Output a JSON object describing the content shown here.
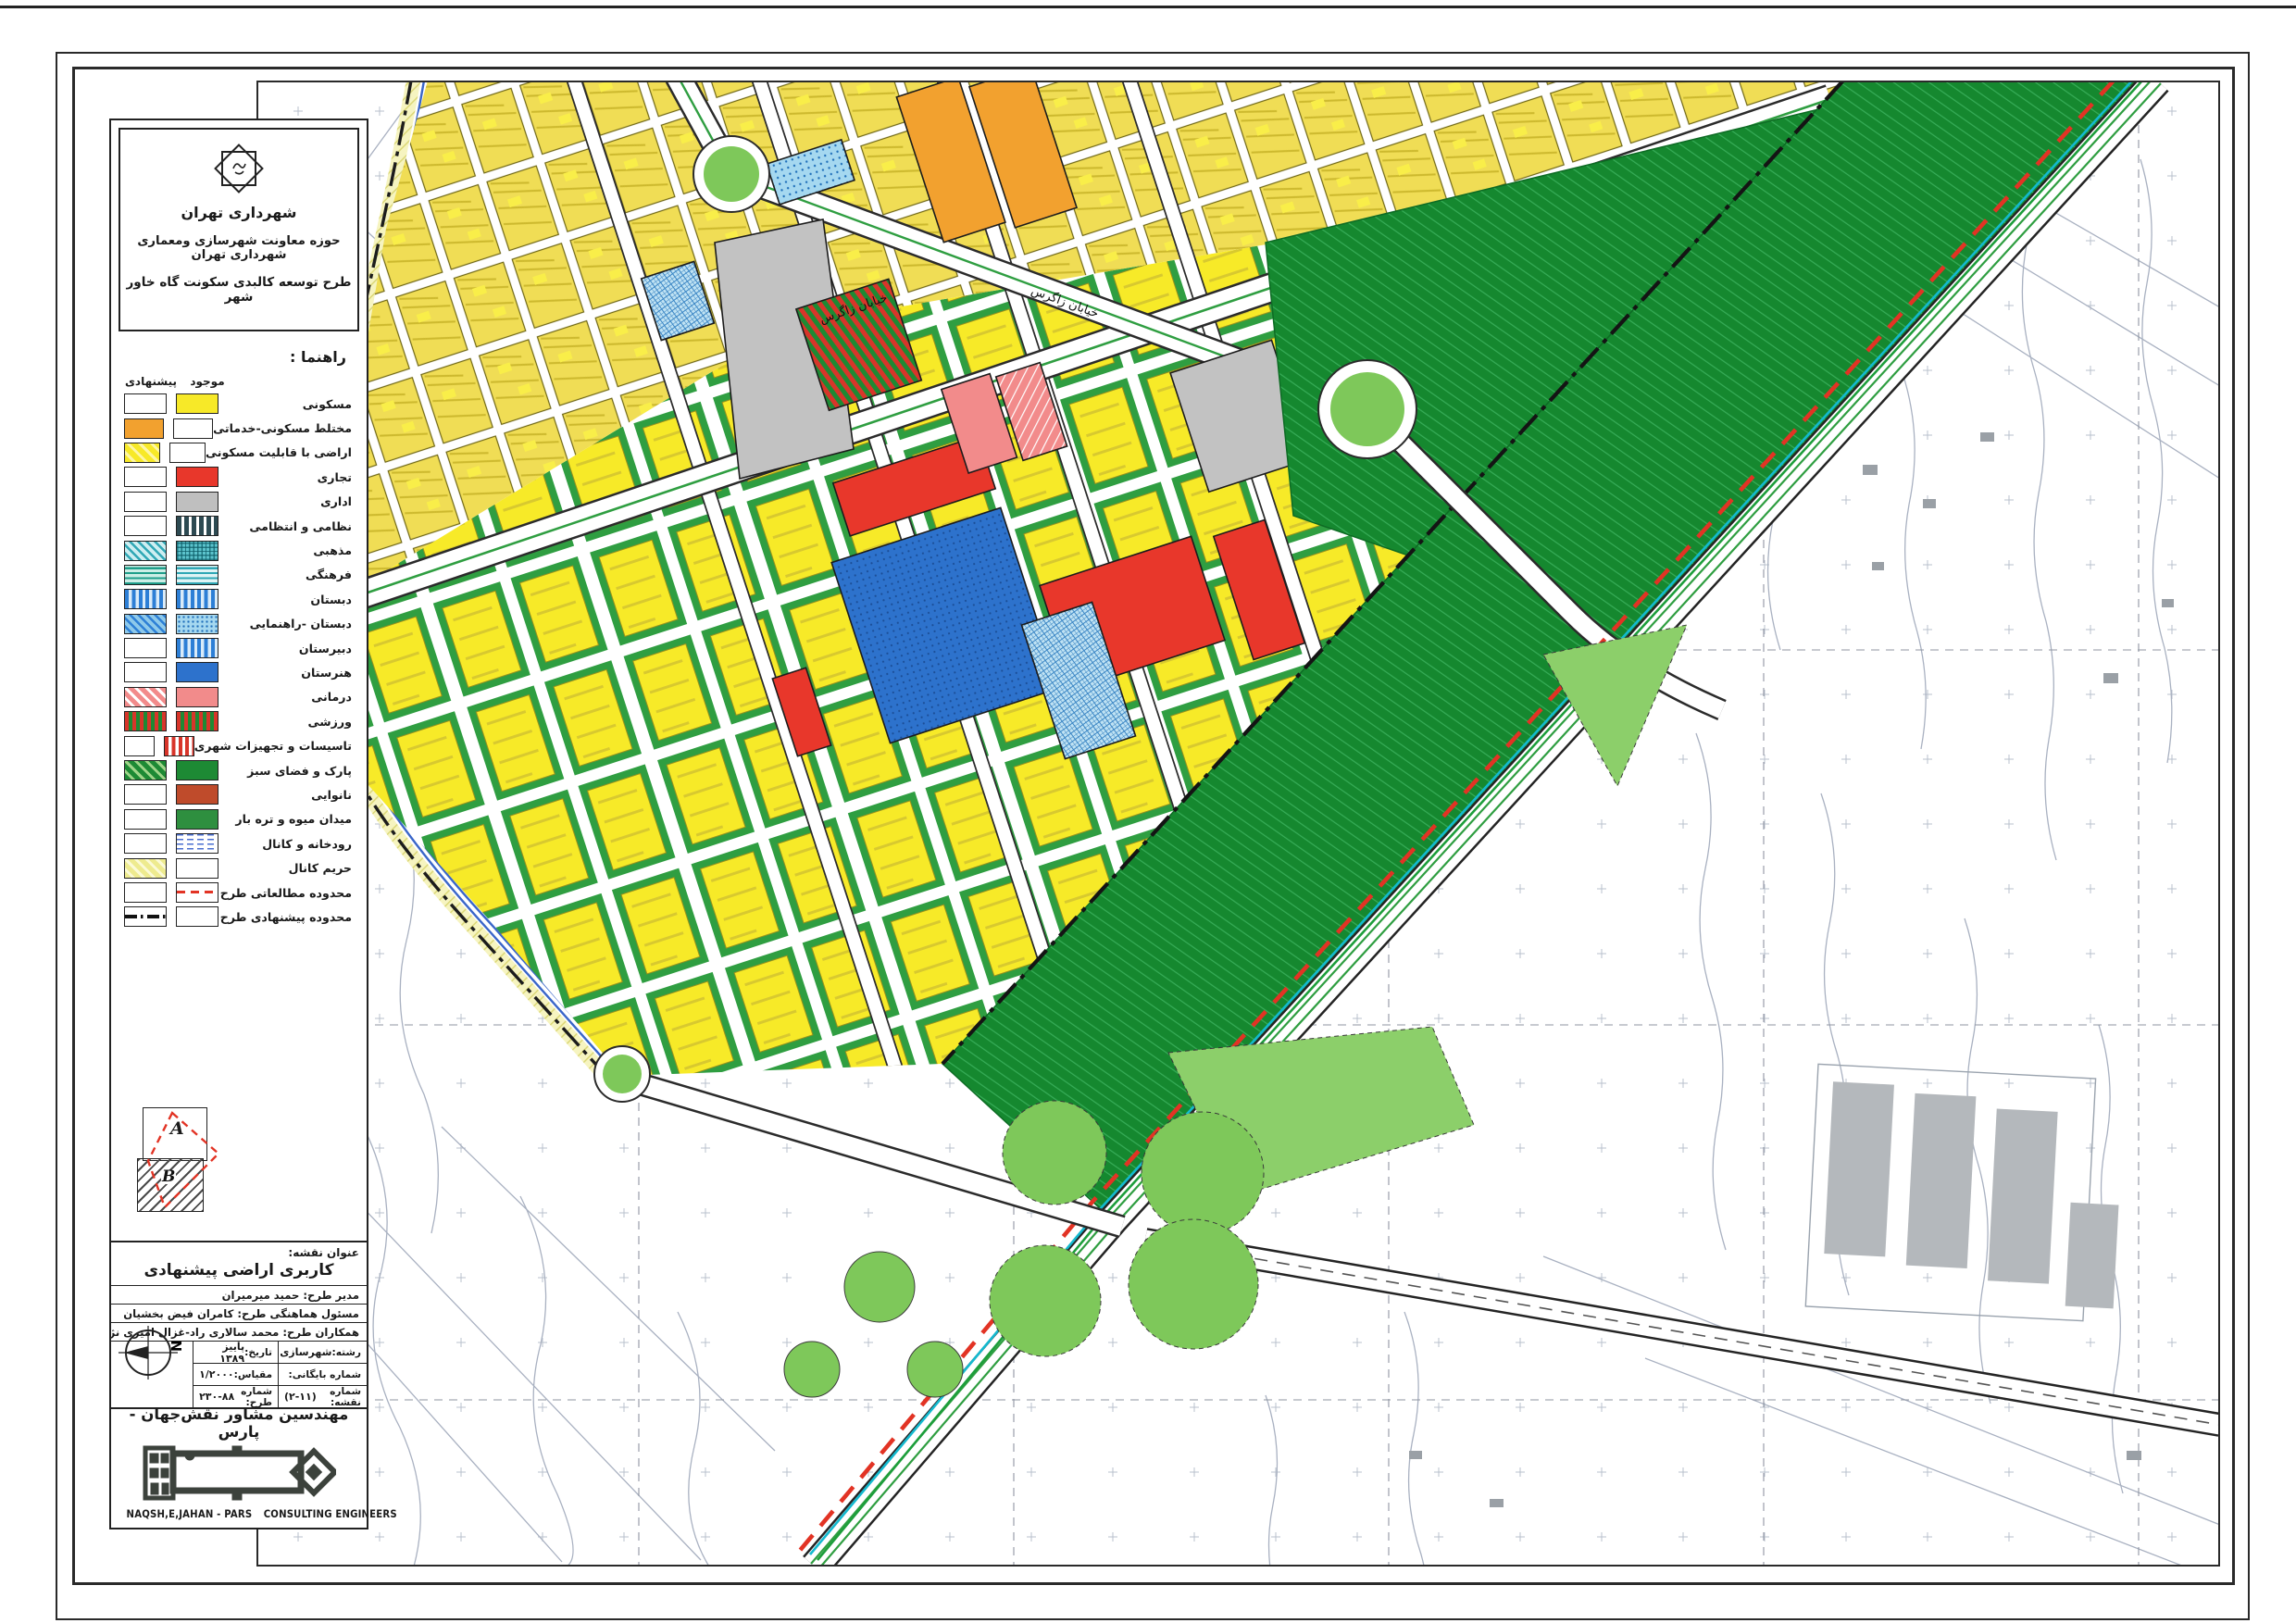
{
  "header": {
    "org": "شهرداری تهران",
    "dept": "حوزه معاونت شهرسازی ومعماری شهرداری تهران",
    "plan": "طرح توسعه کالبدی سکونت گاه خاور شهر"
  },
  "legend": {
    "title": "راهنما :",
    "col_existing": "موجود",
    "col_proposed": "پیشنهادی",
    "items": [
      {
        "label": "مسکونی",
        "existing": "yellow",
        "proposed": "white"
      },
      {
        "label": "مختلط مسکونی-خدماتی",
        "existing": "white",
        "proposed": "orange"
      },
      {
        "label": "اراضی با قابلیت مسکونی",
        "existing": "white",
        "proposed": "yellowhatch"
      },
      {
        "label": "تجاری",
        "existing": "red",
        "proposed": "white"
      },
      {
        "label": "اداری",
        "existing": "gray",
        "proposed": "white"
      },
      {
        "label": "نظامی و انتظامی",
        "existing": "darkvert",
        "proposed": "white"
      },
      {
        "label": "مذهبی",
        "existing": "tealgrid",
        "proposed": "tealhatch"
      },
      {
        "label": "فرهنگی",
        "existing": "tealhoriz",
        "proposed": "tealhoriz2"
      },
      {
        "label": "دبستان",
        "existing": "bluevert",
        "proposed": "bluevert"
      },
      {
        "label": "دبستان -راهنمایی",
        "existing": "bluedots",
        "proposed": "bluediag"
      },
      {
        "label": "دبیرستان",
        "existing": "bluevert",
        "proposed": "white"
      },
      {
        "label": "هنرستان",
        "existing": "bluesolid",
        "proposed": "white"
      },
      {
        "label": "درمانی",
        "existing": "pink",
        "proposed": "pinkhatch"
      },
      {
        "label": "ورزشی",
        "existing": "sports",
        "proposed": "sports"
      },
      {
        "label": "تاسیسات و تجهیزات شهری",
        "existing": "redstripes",
        "proposed": "white"
      },
      {
        "label": "پارک و فضای سبز",
        "existing": "green",
        "proposed": "greenhatch"
      },
      {
        "label": "نانوایی",
        "existing": "brick",
        "proposed": "white"
      },
      {
        "label": "میدان میوه و تره بار",
        "existing": "green2",
        "proposed": "white"
      },
      {
        "label": "رودخانه و کانال",
        "existing": "bluedash",
        "proposed": "white"
      },
      {
        "label": "حریم کانال",
        "existing": "white",
        "proposed": "paleyellowhatch"
      },
      {
        "label": "محدوده مطالعاتی طرح",
        "existing": "reddashline",
        "proposed": "white"
      },
      {
        "label": "محدوده پیشنهادی طرح",
        "existing": "white",
        "proposed": "blackdashdot"
      }
    ]
  },
  "inset": {
    "label_a": "A",
    "label_b": "B"
  },
  "titleblock": {
    "map_title_label": "عنوان نقشه:",
    "map_title": "کاربری اراضی پیشنهادی",
    "rows": [
      {
        "label": "مدیر طرح:",
        "value": "حمید میرمیران"
      },
      {
        "label": "مسئول هماهنگی طرح:",
        "value": "کامران فیض بخشیان"
      },
      {
        "label": "همکاران طرح:",
        "value": "محمد سالاری راد-غزال امیری نژاد-زهرا مالمیر"
      }
    ],
    "meta": {
      "date_label": "تاریخ:",
      "date": "پاییز ۱۳۸۹",
      "scale_label": "مقیاس:",
      "scale": "۱/۲۰۰۰",
      "plan_no_label": "شماره طرح:",
      "plan_no": "۲۳۰-۸۸",
      "field_label": "رشته:",
      "field": "شهرسازی",
      "archive_label": "شماره بایگانی:",
      "archive": "",
      "sheet_label": "شماره نقشه:",
      "sheet": "(۲-۱۱)",
      "compass_letter": "N"
    }
  },
  "company": {
    "name_fa": "مهندسین مشاور نقش‌جهان - پارس",
    "name_en": "NAQSH,E,JAHAN - PARS",
    "type_en": "CONSULTING ENGINEERS"
  },
  "map": {
    "street_labels": [
      "خیابان زاگرس"
    ],
    "coord_labels": {
      "verticals": [
        "3934200",
        "3934600"
      ],
      "horizontals": [
        "550800"
      ]
    }
  },
  "colors": {
    "residential_yellow": "#f7e928",
    "mixed_orange": "#f2a12f",
    "commercial_red": "#e8372b",
    "admin_gray": "#bfbfbf",
    "education_blue": "#2d72cc",
    "medical_pink": "#f28b8b",
    "park_green": "#1d8a34",
    "interchange_light_green": "#7ec85a",
    "canal_blue": "#3a66c9",
    "study_boundary_red": "#e23324",
    "canal_buffer_yellow": "#eeeb8f"
  }
}
